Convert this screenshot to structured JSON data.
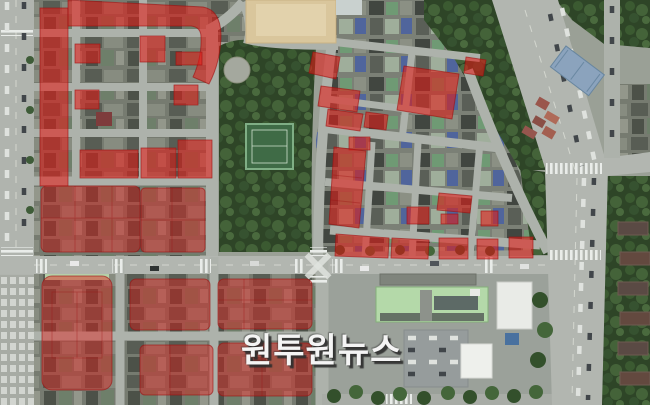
{
  "image": {
    "kind": "aerial-satellite-photo",
    "overlay_meaning": "red-highlighted-city-blocks"
  },
  "colors": {
    "overlay-fill": "#e31b17",
    "overlay-stroke": "#9c0f0f",
    "watermark": "#f4f4f4",
    "road": "#adb2ab",
    "park-green": "#2e4527",
    "sand-yard": "#d9c69c"
  },
  "watermark": {
    "text": "원투원뉴스"
  }
}
